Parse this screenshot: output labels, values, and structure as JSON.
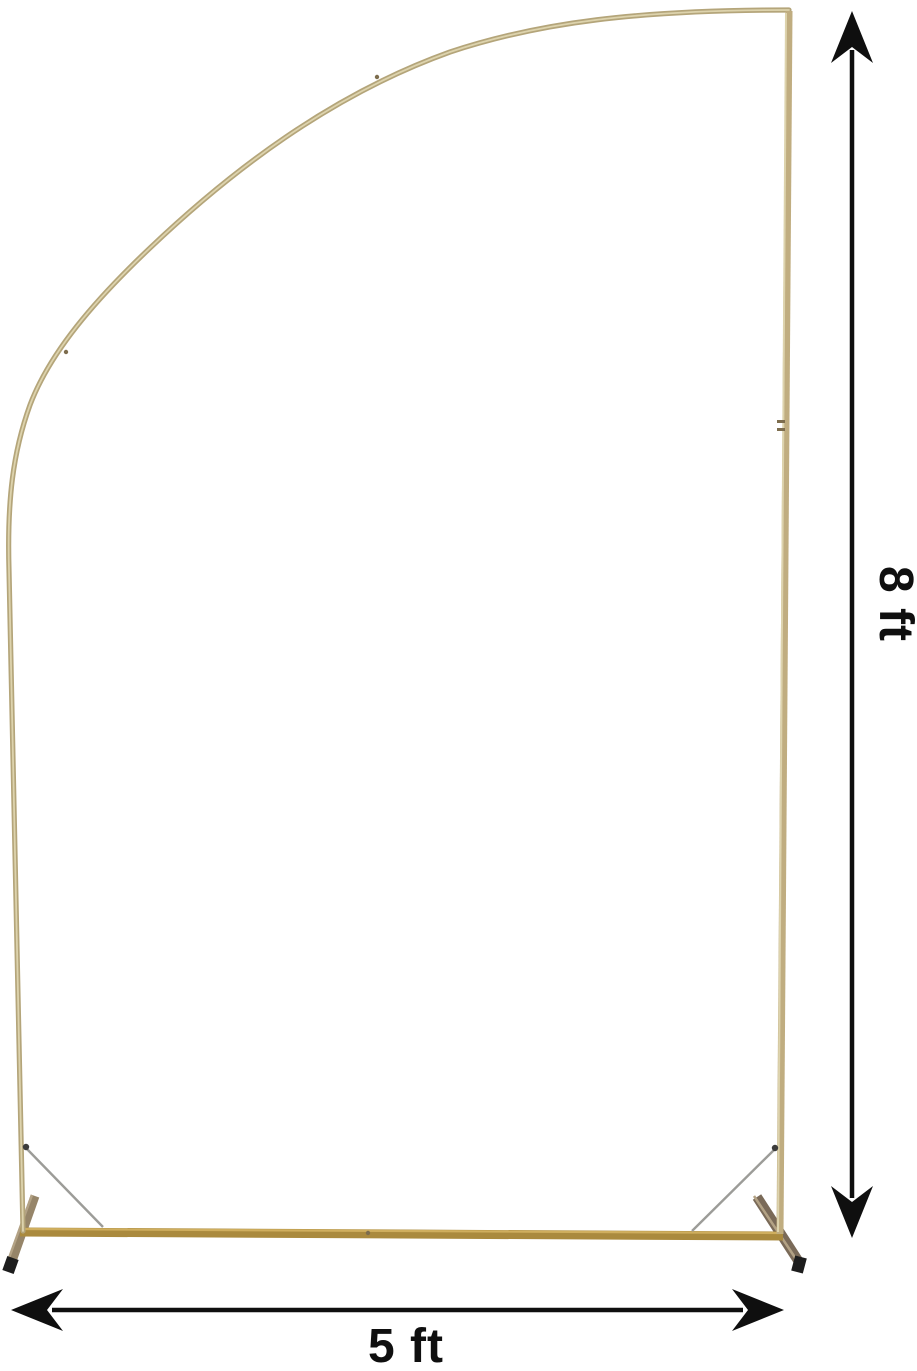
{
  "figure": {
    "type": "product-dimension-diagram",
    "subject": "gold half-arch backdrop stand",
    "parts": [
      "left-arch-tube",
      "right-vertical-pole",
      "base-bar",
      "left-foot",
      "right-foot",
      "left-support-wire",
      "right-support-wire"
    ]
  },
  "annotations": {
    "height_label": "8 ft",
    "width_label": "5 ft"
  },
  "colors": {
    "background": "#ffffff",
    "frame_gold": "#b4a57a",
    "frame_gold_light": "#ddd3ad",
    "pole_gold": "#c0ad80",
    "base_gold": "#aa8a3e",
    "base_gold_light": "#cfae5e",
    "foot_left": "#968569",
    "foot_right": "#7a6a58",
    "foot_highlight": "#b3a285",
    "foot_cap": "#1d1d1d",
    "wire_gray": "#9c9c98",
    "wire_dot": "#3c3c3c",
    "joint": "#7d6d4e",
    "annotation": "#0f0f0f"
  }
}
